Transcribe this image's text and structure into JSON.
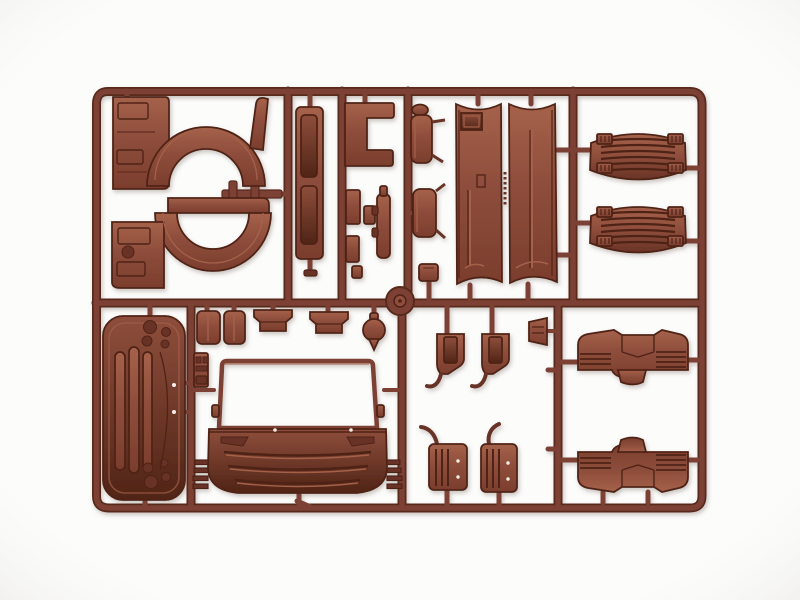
{
  "scene": {
    "description": "Photograph of an injection-molded plastic model kit sprue (parts tree) molded in reddish-brown plastic on a plain white background. The rectangular runner frame holds unpainted truck-cab parts: rear wheel-arch panels, a door trim strip, a C-shaped bracket, two rear-view mirrors, two long curved cab side/roof panels, two ribbed mud flaps, a front grille panel, the cab front with windscreen frame and grille slats, small brackets and steps, and two front fenders.",
    "subject": "plastic-model-kit-sprue",
    "plastic_color_name": "reddish-brown"
  },
  "palette": {
    "background": "#fcfcfb",
    "vignette": "#ecebe9",
    "runner": "#7c4134",
    "runner_dark": "#59291d",
    "plastic_base": "#8e4e3c",
    "plastic_dark": "#693326",
    "plastic_darker": "#502416",
    "plastic_highlight": "#a5614a",
    "plastic_deep": "#7b3d2d",
    "ejector_dot": "#f6efe9",
    "shadow": "#9a8c85"
  },
  "parts": [
    {
      "id": "rear-wheel-arch-upper",
      "desc": "cab rear quarter panel with wheel arch, upper left"
    },
    {
      "id": "rear-wheel-arch-lower",
      "desc": "mirrored cab rear quarter panel with wheel arch"
    },
    {
      "id": "door-trim-strip",
      "desc": "narrow door trim panel with two recessed windows"
    },
    {
      "id": "c-bracket",
      "desc": "C-shaped mounting bracket"
    },
    {
      "id": "small-blocks",
      "desc": "assorted small rectangular fittings"
    },
    {
      "id": "exhaust-strip",
      "desc": "thin strip part with side nubs"
    },
    {
      "id": "mirror-upper",
      "desc": "rear-view mirror housing with arms"
    },
    {
      "id": "mirror-lower",
      "desc": "second rear-view mirror housing"
    },
    {
      "id": "roof-panel-left",
      "desc": "long curved cab panel with roof hatch recess"
    },
    {
      "id": "roof-panel-right",
      "desc": "long curved cab panel with center groove"
    },
    {
      "id": "mud-flap-upper",
      "desc": "ribbed mud flap, barrel shaped"
    },
    {
      "id": "mud-flap-lower",
      "desc": "ribbed mud flap, barrel shaped"
    },
    {
      "id": "front-grille-panel",
      "desc": "front grille panel with three louvers and lamp holes"
    },
    {
      "id": "seat-boxes",
      "desc": "two small box fittings"
    },
    {
      "id": "step-wedges",
      "desc": "two entry step wedges"
    },
    {
      "id": "round-knob",
      "desc": "round knob with stem"
    },
    {
      "id": "door-hinge-plate",
      "desc": "small hinge plate beside windscreen"
    },
    {
      "id": "windscreen-frame",
      "desc": "open windscreen frame of the cab front"
    },
    {
      "id": "cab-front-panel",
      "desc": "cab front panel with grille slats and side steps"
    },
    {
      "id": "bracket-left",
      "desc": "pentagonal bracket with hook"
    },
    {
      "id": "bracket-right",
      "desc": "pentagonal bracket with hook"
    },
    {
      "id": "wedge-clip",
      "desc": "small trapezoid clip"
    },
    {
      "id": "step-panel-left",
      "desc": "ribbed step panel with curved arm"
    },
    {
      "id": "step-panel-right",
      "desc": "ribbed step panel with curved arm"
    },
    {
      "id": "front-fender-upper",
      "desc": "front fender with ribbed edges"
    },
    {
      "id": "front-fender-lower",
      "desc": "mirrored front fender with ribbed edges"
    },
    {
      "id": "runner-hub",
      "desc": "round injection gate hub at runner junction"
    }
  ]
}
